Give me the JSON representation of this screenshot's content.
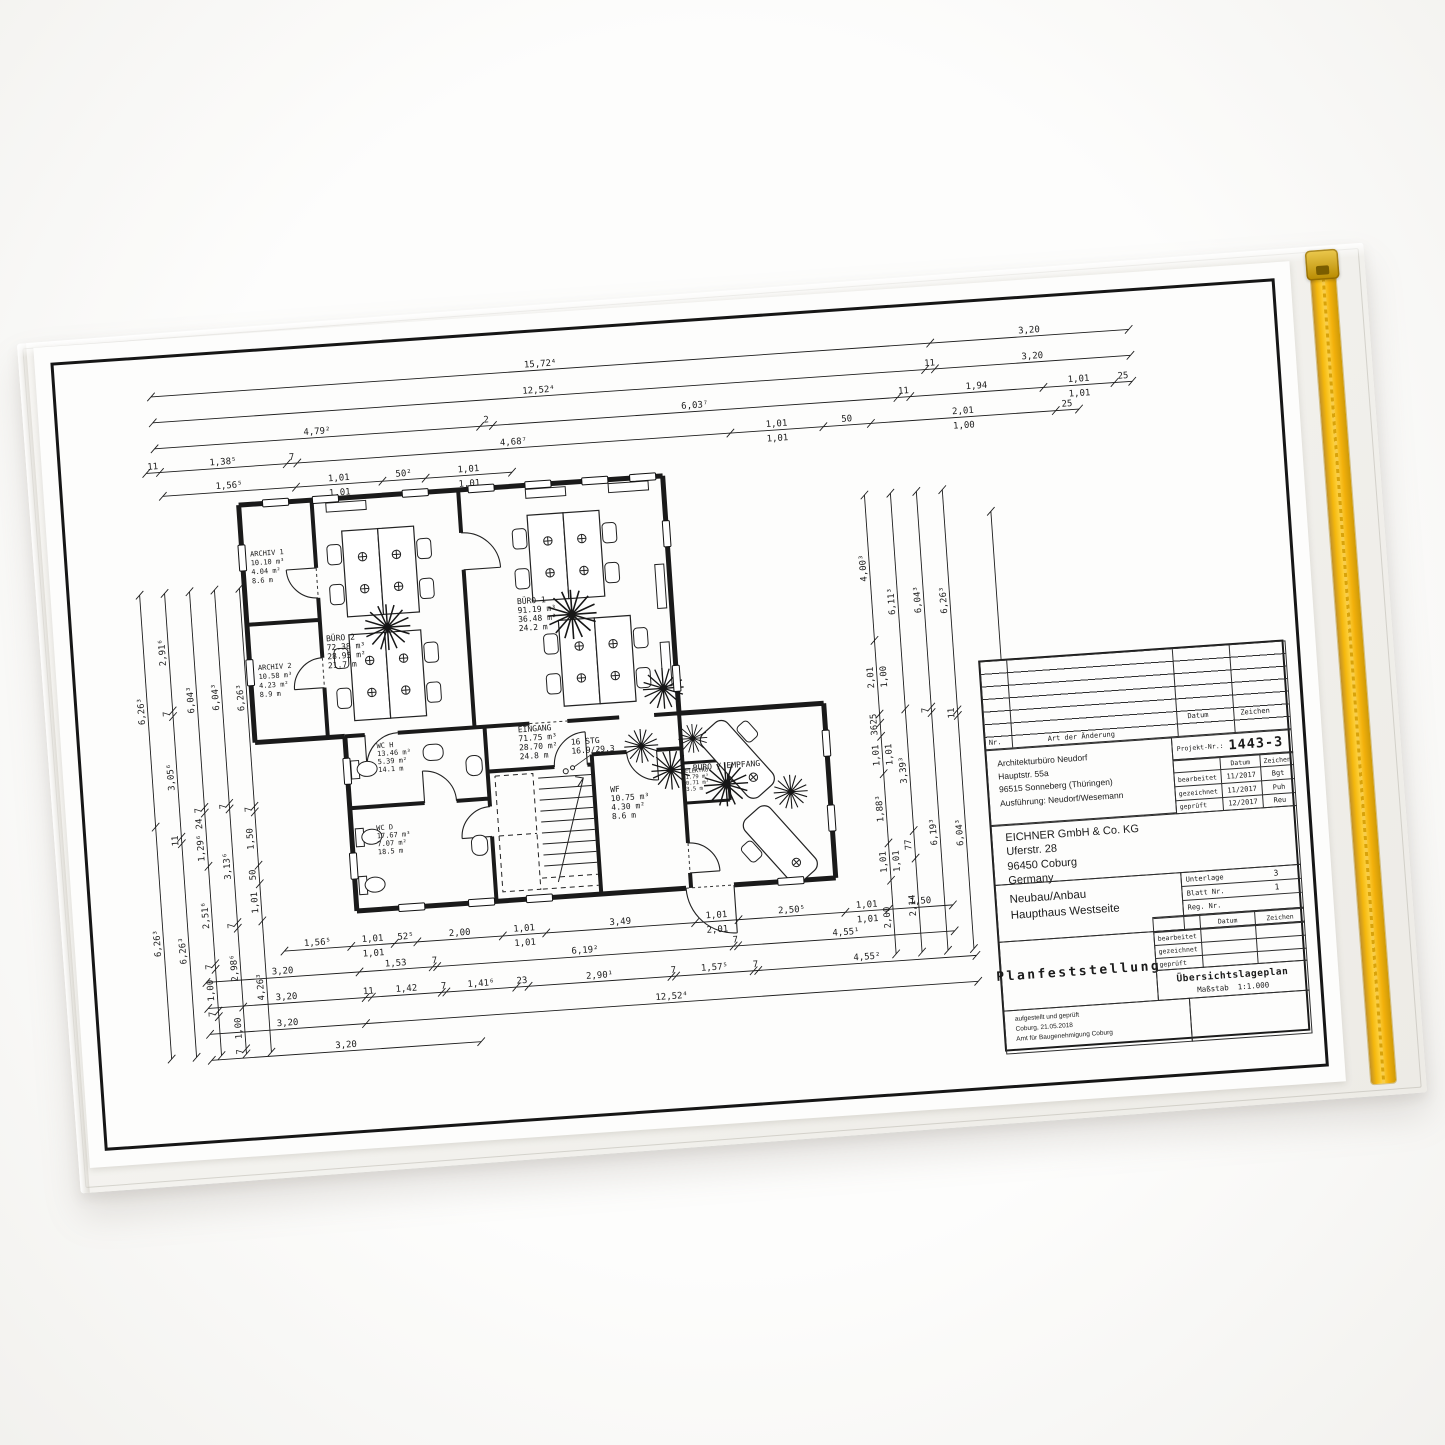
{
  "colors": {
    "zipper": "#F4B70C",
    "sleeve": "#F4F3F0",
    "paper": "#FDFDFC",
    "ink": "#1A1A1A",
    "background": "#F7F6F4"
  },
  "drawing": {
    "rooms": [
      {
        "name": "ARCHIV 1",
        "l": [
          "10.10 m³",
          "4.04 m²",
          "8.6 m"
        ]
      },
      {
        "name": "BÜRO 2",
        "l": [
          "72.38 m³",
          "28.95 m²",
          "21.7 m"
        ]
      },
      {
        "name": "ARCHIV 2",
        "l": [
          "10.58 m³",
          "4.23 m²",
          "8.9 m"
        ]
      },
      {
        "name": "BÜRO 1",
        "l": [
          "91.19 m³",
          "36.48 m²",
          "24.2 m"
        ]
      },
      {
        "name": "EINGANG",
        "l": [
          "71.75 m³",
          "28.70 m²",
          "24.8 m"
        ]
      },
      {
        "name": "WC H",
        "l": [
          "13.46 m³",
          "5.39 m²",
          "14.1 m"
        ]
      },
      {
        "name": "WC D",
        "l": [
          "17.67 m³",
          "7.07 m²",
          "18.5 m"
        ]
      },
      {
        "name": "WF",
        "l": [
          "10.75 m³",
          "4.30 m²",
          "8.6 m"
        ]
      },
      {
        "name": "ELEKTRO",
        "l": [
          "1.79 m³",
          "0.71 m²",
          "3.5 m"
        ]
      },
      {
        "name": "BÜRO / EMPFANG",
        "l": []
      },
      {
        "name": "16 STG",
        "l": [
          "16.9/29.3"
        ]
      }
    ],
    "dims": [
      {
        "x1": 95,
        "y1": 38,
        "x2": 1075,
        "y2": 38,
        "s": [
          {
            "w": 0.797,
            "t": "15,72⁴"
          },
          {
            "w": 0.203,
            "t": "3,20"
          }
        ]
      },
      {
        "x1": 95,
        "y1": 64,
        "x2": 1075,
        "y2": 64,
        "s": [
          {
            "w": 0.79,
            "t": "12,52⁴"
          },
          {
            "w": 0.01,
            "t": "11"
          },
          {
            "w": 0.2,
            "t": "3,20"
          }
        ]
      },
      {
        "x1": 95,
        "y1": 90,
        "x2": 1075,
        "y2": 90,
        "s": [
          {
            "w": 0.33,
            "t": "4,79²"
          },
          {
            "w": 0.013,
            "t": "2"
          },
          {
            "w": 0.41,
            "t": "6,03⁷"
          },
          {
            "w": 0.013,
            "t": "11"
          },
          {
            "w": 0.135,
            "t": "1,94"
          },
          {
            "w": 0.072,
            "t": "1,01",
            "b": "1,01"
          },
          {
            "w": 0.018,
            "t": "25"
          }
        ]
      },
      {
        "x1": 85,
        "y1": 114,
        "x2": 1020,
        "y2": 114,
        "s": [
          {
            "w": 0.013,
            "t": "11"
          },
          {
            "w": 0.12,
            "t": "1,38⁵"
          },
          {
            "w": 0.01,
            "t": "7"
          },
          {
            "w": 0.41,
            "t": "4,68⁷"
          },
          {
            "w": 0.088,
            "t": "1,01",
            "b": "1,01"
          },
          {
            "w": 0.045,
            "t": "50"
          },
          {
            "w": 0.175,
            "t": "2,01",
            "b": "1,00"
          },
          {
            "w": 0.022,
            "t": "25"
          }
        ]
      },
      {
        "x1": 100,
        "y1": 138,
        "x2": 450,
        "y2": 138,
        "s": [
          {
            "w": 0.37,
            "t": "1,56⁵"
          },
          {
            "w": 0.24,
            "t": "1,01",
            "b": "1,01"
          },
          {
            "w": 0.12,
            "t": "50²"
          },
          {
            "w": 0.24,
            "t": "1,01",
            "b": "1,01"
          }
        ]
      },
      {
        "x1": 70,
        "y1": 235,
        "x2": 70,
        "y2": 700,
        "s": [
          {
            "w": 0.5,
            "t": "6,26³"
          },
          {
            "w": 0.5,
            "t": "6,26³"
          }
        ]
      },
      {
        "x1": 95,
        "y1": 235,
        "x2": 95,
        "y2": 700,
        "s": [
          {
            "w": 0.253,
            "t": "2,91⁶"
          },
          {
            "w": 0.012,
            "t": "7"
          },
          {
            "w": 0.26,
            "t": "3,05⁶"
          },
          {
            "w": 0.014,
            "t": "11"
          },
          {
            "w": 0.46,
            "t": "6,26³"
          }
        ]
      },
      {
        "x1": 120,
        "y1": 235,
        "x2": 120,
        "y2": 700,
        "s": [
          {
            "w": 0.465,
            "t": "6,04³"
          },
          {
            "w": 0.012,
            "t": "7"
          },
          {
            "w": 0.115,
            "t": "1,29⁶ 24"
          },
          {
            "w": 0.21,
            "t": "2,51⁶"
          },
          {
            "w": 0.012,
            "t": "7"
          },
          {
            "w": 0.09,
            "t": "1,00"
          },
          {
            "w": 0.012,
            "t": "7"
          },
          {
            "w": 0.084,
            "t": ""
          }
        ]
      },
      {
        "x1": 145,
        "y1": 235,
        "x2": 145,
        "y2": 700,
        "s": [
          {
            "w": 0.46,
            "t": "6,04³"
          },
          {
            "w": 0.012,
            "t": "7"
          },
          {
            "w": 0.245,
            "t": "3,13⁶"
          },
          {
            "w": 0.012,
            "t": "7"
          },
          {
            "w": 0.17,
            "t": "2,98⁶"
          },
          {
            "w": 0.09,
            "t": "1,00"
          },
          {
            "w": 0.011,
            "t": "7"
          }
        ]
      },
      {
        "x1": 170,
        "y1": 235,
        "x2": 170,
        "y2": 700,
        "s": [
          {
            "w": 0.47,
            "t": "6,26³"
          },
          {
            "w": 0.012,
            "t": "7"
          },
          {
            "w": 0.115,
            "t": "1,50"
          },
          {
            "w": 0.04,
            "t": "50"
          },
          {
            "w": 0.08,
            "t": "1,01"
          },
          {
            "w": 0.283,
            "t": "4,26³"
          }
        ]
      },
      {
        "x1": 800,
        "y1": 185,
        "x2": 800,
        "y2": 645,
        "s": [
          {
            "w": 0.3,
            "t": "4,00³"
          },
          {
            "w": 0.152,
            "t": "2,01",
            "b": "1,00"
          },
          {
            "w": 0.019,
            "t": "25"
          },
          {
            "w": 0.027,
            "t": "36"
          },
          {
            "w": 0.077,
            "t": "1,01",
            "b": "1,01"
          },
          {
            "w": 0.143,
            "t": "1,88³"
          },
          {
            "w": 0.077,
            "t": "1,01",
            "b": "1,01"
          },
          {
            "w": 0.152,
            "t": "2,00"
          }
        ]
      },
      {
        "x1": 826,
        "y1": 185,
        "x2": 826,
        "y2": 645,
        "s": [
          {
            "w": 0.47,
            "t": "6,11³"
          },
          {
            "w": 0.265,
            "t": "3,39³"
          },
          {
            "w": 0.06,
            "t": "77"
          },
          {
            "w": 0.205,
            "t": "2,14"
          }
        ]
      },
      {
        "x1": 852,
        "y1": 185,
        "x2": 852,
        "y2": 645,
        "s": [
          {
            "w": 0.47,
            "t": "6,04³"
          },
          {
            "w": 0.012,
            "t": "7"
          },
          {
            "w": 0.518,
            "t": "6,19³"
          }
        ]
      },
      {
        "x1": 878,
        "y1": 185,
        "x2": 878,
        "y2": 645,
        "s": [
          {
            "w": 0.48,
            "t": "6,26³"
          },
          {
            "w": 0.012,
            "t": "11"
          },
          {
            "w": 0.508,
            "t": "6,04³"
          }
        ]
      },
      {
        "x1": 925,
        "y1": 210,
        "x2": 925,
        "y2": 630,
        "s": [
          {
            "w": 1,
            "t": "12,52⁴"
          }
        ]
      },
      {
        "x1": 190,
        "y1": 600,
        "x2": 860,
        "y2": 600,
        "s": [
          {
            "w": 0.1,
            "t": "1,56⁵"
          },
          {
            "w": 0.065,
            "t": "1,01",
            "b": "1,01"
          },
          {
            "w": 0.034,
            "t": "52⁵"
          },
          {
            "w": 0.128,
            "t": "2,00"
          },
          {
            "w": 0.065,
            "t": "1,01",
            "b": "1,01"
          },
          {
            "w": 0.223,
            "t": "3,49"
          },
          {
            "w": 0.065,
            "t": "1,01",
            "b": "2,01"
          },
          {
            "w": 0.16,
            "t": "2,50⁵"
          },
          {
            "w": 0.065,
            "t": "1,01",
            "b": "1,01"
          },
          {
            "w": 0.096,
            "t": "1,50"
          }
        ]
      },
      {
        "x1": 110,
        "y1": 626,
        "x2": 860,
        "y2": 626,
        "s": [
          {
            "w": 0.205,
            "t": "3,20"
          },
          {
            "w": 0.098,
            "t": "1,53"
          },
          {
            "w": 0.006,
            "t": "7"
          },
          {
            "w": 0.397,
            "t": "6,19²"
          },
          {
            "w": 0.006,
            "t": "7"
          },
          {
            "w": 0.29,
            "t": "4,55¹"
          }
        ]
      },
      {
        "x1": 110,
        "y1": 652,
        "x2": 880,
        "y2": 652,
        "s": [
          {
            "w": 0.205,
            "t": "3,20"
          },
          {
            "w": 0.008,
            "t": "11"
          },
          {
            "w": 0.091,
            "t": "1,42"
          },
          {
            "w": 0.006,
            "t": "7"
          },
          {
            "w": 0.091,
            "t": "1,41⁶"
          },
          {
            "w": 0.016,
            "t": "23"
          },
          {
            "w": 0.186,
            "t": "2,90¹"
          },
          {
            "w": 0.006,
            "t": "7"
          },
          {
            "w": 0.101,
            "t": "1,57⁵"
          },
          {
            "w": 0.006,
            "t": "7"
          },
          {
            "w": 0.284,
            "t": "4,55²"
          }
        ]
      },
      {
        "x1": 110,
        "y1": 678,
        "x2": 880,
        "y2": 678,
        "s": [
          {
            "w": 0.203,
            "t": "3,20"
          },
          {
            "w": 0.797,
            "t": "12,52⁴"
          }
        ]
      },
      {
        "x1": 110,
        "y1": 704,
        "x2": 380,
        "y2": 704,
        "s": [
          {
            "w": 1,
            "t": "3,20"
          }
        ]
      }
    ]
  },
  "title_block": {
    "nr_label": "Nr.",
    "art_label": "Art der Änderung",
    "datum_label": "Datum",
    "zeichen_label": "Zeichen",
    "projekt_label": "Projekt-Nr.:",
    "projekt_nr": "1443-3",
    "architect": [
      "Architekturbüro Neudorf",
      "Hauptstr. 55a",
      "96515 Sonneberg (Thüringen)",
      "Ausführung: Neudorf/Wesemann"
    ],
    "sig_rows": [
      {
        "label": "bearbeitet",
        "datum": "11/2017",
        "zeichen": "Bgt"
      },
      {
        "label": "gezeichnet",
        "datum": "11/2017",
        "zeichen": "Puh"
      },
      {
        "label": "geprüft",
        "datum": "12/2017",
        "zeichen": "Reu"
      }
    ],
    "client": [
      "EICHNER GmbH & Co. KG",
      "Uferstr. 28",
      "96450 Coburg",
      "Germany"
    ],
    "project": [
      "Neubau/Anbau",
      "Haupthaus Westseite"
    ],
    "doc_rows": [
      {
        "label": "Unterlage",
        "value": "3"
      },
      {
        "label": "Blatt Nr.",
        "value": "1"
      },
      {
        "label": "Reg. Nr.",
        "value": ""
      }
    ],
    "sig_rows2": [
      "bearbeitet",
      "gezeichnet",
      "geprüft"
    ],
    "main_title": "Planfeststellung",
    "sub_title": "Übersichtslageplan",
    "scale_label": "Maßstab",
    "scale_value": "1:1.000",
    "approval": [
      "aufgestellt und geprüft",
      "Coburg, 21.05.2018",
      "Amt für Baugenehmigung Coburg"
    ]
  }
}
